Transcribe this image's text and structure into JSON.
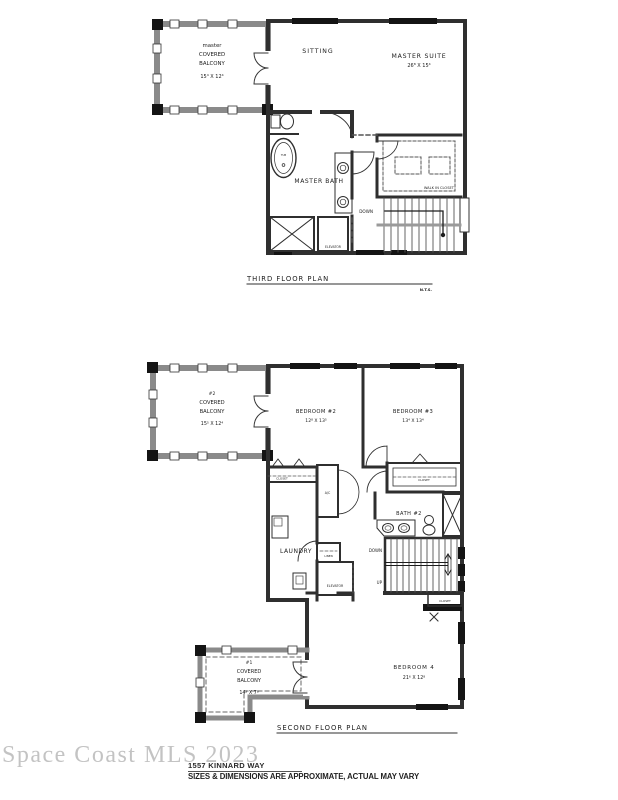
{
  "colors": {
    "wall": "#2f2f2f",
    "balcony_wall": "#8a8a8a",
    "window_fill": "#141414",
    "watermark": "#b5b5b5"
  },
  "third_floor": {
    "title": "THIRD FLOOR PLAN",
    "scale_note": "N.T.S.",
    "balcony": {
      "l1": "master",
      "l2": "COVERED",
      "l3": "BALCONY",
      "dims": "15⁴ X 12⁴"
    },
    "sitting": "SITTING",
    "suite_name": "MASTER SUITE",
    "suite_dims": "26⁸ X 15⁴",
    "bath": "MASTER BATH",
    "tub": "TUB",
    "walk_in_closet": "WALK IN CLOSET",
    "down": "DOWN",
    "elevator": "ELEVATOR"
  },
  "second_floor": {
    "title": "SECOND FLOOR PLAN",
    "balcony2": {
      "l1": "#2",
      "l2": "COVERED",
      "l3": "BALCONY",
      "dims": "15⁵ X 12⁴"
    },
    "bedroom2": {
      "name": "BEDROOM #2",
      "dims": "12⁸ X 13⁵"
    },
    "bedroom3": {
      "name": "BEDROOM #3",
      "dims": "13⁴ X 13⁴"
    },
    "bedroom4": {
      "name": "BEDROOM 4",
      "dims": "21⁶ X 12⁸"
    },
    "balcony1": {
      "l1": "#1",
      "l2": "COVERED",
      "l3": "BALCONY",
      "dims": "14² X 7⁸"
    },
    "bath2": "BATH #2",
    "closet": "CLOSET",
    "ac": "A/C",
    "laundry": "LAUNDRY",
    "linen": "LINEN",
    "elevator": "ELEVATOR",
    "down": "DOWN",
    "up": "UP"
  },
  "footer": {
    "watermark": "Space Coast MLS 2023",
    "address": "1557 KINNARD WAY",
    "disclaimer": "SIZES & DIMENSIONS ARE APPROXIMATE, ACTUAL MAY VARY"
  }
}
